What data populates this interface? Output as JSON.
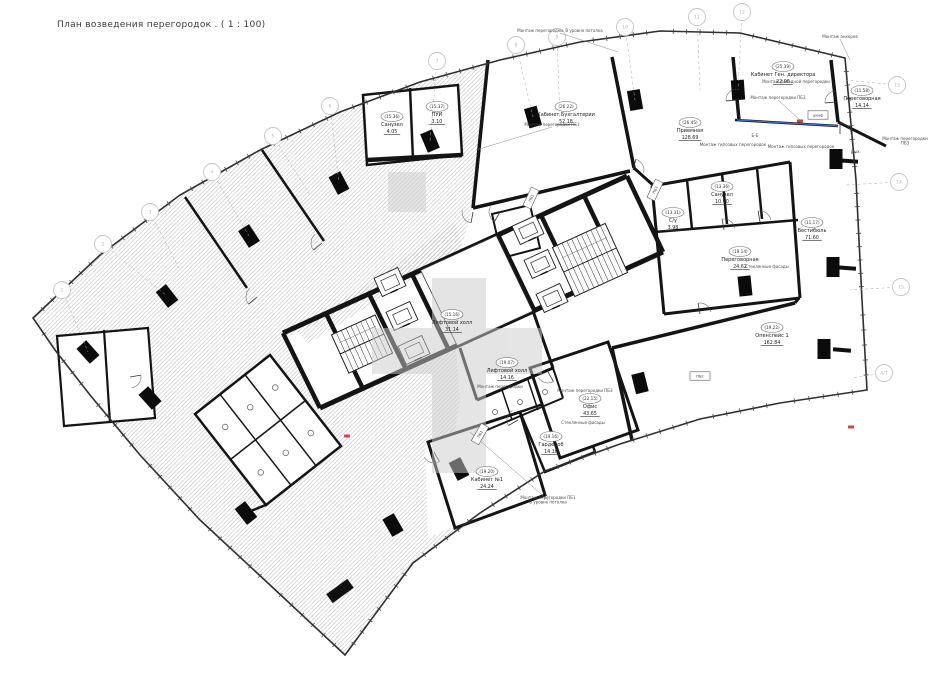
{
  "title": "План возведения перегородок . ( 1 : 100)",
  "colors": {
    "wall": "#141414",
    "thin_line": "#3a3a3a",
    "hatch": "#b3b3b3",
    "bubble": "#c4c4c4",
    "watermark": "#cbcbcb",
    "accent_blue": "#3a6fd8",
    "accent_red": "#d04545"
  },
  "plan": {
    "outline": [
      [
        33,
        318
      ],
      [
        100,
        255
      ],
      [
        180,
        195
      ],
      [
        260,
        150
      ],
      [
        340,
        112
      ],
      [
        420,
        82
      ],
      [
        500,
        60
      ],
      [
        580,
        42
      ],
      [
        660,
        31
      ],
      [
        740,
        33
      ],
      [
        845,
        58
      ],
      [
        856,
        180
      ],
      [
        862,
        300
      ],
      [
        867,
        390
      ],
      [
        780,
        403
      ],
      [
        700,
        419
      ],
      [
        620,
        444
      ],
      [
        545,
        471
      ],
      [
        480,
        513
      ],
      [
        413,
        563
      ],
      [
        345,
        655
      ],
      [
        270,
        585
      ],
      [
        200,
        520
      ],
      [
        140,
        455
      ],
      [
        90,
        395
      ],
      [
        55,
        350
      ]
    ],
    "white_zone": [
      [
        490,
        58
      ],
      [
        560,
        45
      ],
      [
        640,
        33
      ],
      [
        700,
        29
      ],
      [
        760,
        37
      ],
      [
        845,
        58
      ],
      [
        856,
        180
      ],
      [
        862,
        300
      ],
      [
        867,
        390
      ],
      [
        780,
        403
      ],
      [
        700,
        419
      ],
      [
        620,
        444
      ],
      [
        545,
        471
      ],
      [
        505,
        494
      ],
      [
        455,
        526
      ],
      [
        428,
        538
      ],
      [
        425,
        445
      ],
      [
        455,
        430
      ],
      [
        460,
        400
      ],
      [
        456,
        350
      ],
      [
        322,
        410
      ],
      [
        286,
        338
      ],
      [
        460,
        252
      ],
      [
        473,
        208
      ]
    ],
    "hatch_patches": [
      [
        [
          298,
          332
        ],
        [
          455,
          222
        ],
        [
          462,
          248
        ],
        [
          308,
          344
        ]
      ]
    ],
    "white_rooms": [
      {
        "p": [
          [
            363,
            95
          ],
          [
            458,
            85
          ],
          [
            462,
            155
          ],
          [
            367,
            165
          ]
        ],
        "w": 2.5
      },
      {
        "p": [
          [
            195,
            414
          ],
          [
            270,
            355
          ],
          [
            341,
            446
          ],
          [
            266,
            505
          ]
        ],
        "w": 2.5,
        "grid": "wc"
      },
      {
        "p": [
          [
            57,
            336
          ],
          [
            148,
            328
          ],
          [
            155,
            418
          ],
          [
            64,
            426
          ]
        ],
        "w": 2.2
      },
      {
        "p": [
          [
            428,
            442
          ],
          [
            520,
            412
          ],
          [
            545,
            495
          ],
          [
            455,
            528
          ]
        ],
        "w": 3
      },
      {
        "p": [
          [
            520,
            412
          ],
          [
            575,
            393
          ],
          [
            595,
            452
          ],
          [
            545,
            472
          ]
        ],
        "w": 2.5
      },
      {
        "p": [
          [
            530,
            368
          ],
          [
            608,
            342
          ],
          [
            638,
            430
          ],
          [
            560,
            458
          ]
        ],
        "w": 3
      },
      {
        "p": [
          [
            492,
            214
          ],
          [
            530,
            205
          ],
          [
            540,
            248
          ],
          [
            502,
            258
          ]
        ],
        "w": 2
      }
    ],
    "walls": [
      [
        488,
        60,
        473,
        208,
        3.5
      ],
      [
        473,
        208,
        630,
        171,
        3.5
      ],
      [
        612,
        57,
        634,
        168,
        3.5
      ],
      [
        634,
        168,
        654,
        186,
        3
      ],
      [
        733,
        57,
        739,
        120,
        3.5
      ],
      [
        831,
        60,
        838,
        122,
        3.5
      ],
      [
        838,
        122,
        886,
        146,
        3
      ],
      [
        652,
        186,
        790,
        162,
        3
      ],
      [
        790,
        162,
        800,
        298,
        3
      ],
      [
        652,
        186,
        664,
        314,
        3
      ],
      [
        655,
        232,
        798,
        220,
        2.5
      ],
      [
        687,
        180,
        692,
        229,
        2.5
      ],
      [
        722,
        174,
        727,
        224,
        2.5
      ],
      [
        757,
        168,
        762,
        219,
        2.5
      ],
      [
        664,
        314,
        800,
        298,
        3
      ],
      [
        612,
        348,
        795,
        303,
        3.5
      ],
      [
        795,
        303,
        799,
        298,
        3
      ],
      [
        612,
        348,
        632,
        440,
        3.5
      ],
      [
        533,
        311,
        553,
        368,
        3
      ],
      [
        553,
        368,
        477,
        400,
        3
      ],
      [
        477,
        400,
        460,
        348,
        3
      ],
      [
        553,
        368,
        563,
        398,
        2
      ],
      [
        563,
        398,
        487,
        430,
        2
      ],
      [
        502,
        390,
        512,
        420,
        1.5
      ],
      [
        528,
        380,
        538,
        410,
        1.5
      ],
      [
        185,
        197,
        247,
        288,
        2.5
      ],
      [
        262,
        150,
        324,
        241,
        2.5
      ],
      [
        246,
        513,
        268,
        504,
        2.5
      ],
      [
        410,
        88,
        413,
        160,
        2.5
      ],
      [
        367,
        160,
        462,
        155,
        4.5
      ],
      [
        104,
        330,
        110,
        423,
        2.2
      ],
      [
        735,
        120,
        838,
        126,
        2.5
      ]
    ],
    "wall_stubs": [
      [
        340,
        591,
        26,
        11,
        -36
      ],
      [
        848,
        161,
        20,
        4,
        4
      ],
      [
        846,
        268,
        20,
        4,
        4
      ],
      [
        842,
        350,
        18,
        4,
        5
      ]
    ],
    "columns": [
      [
        88,
        352,
        -42
      ],
      [
        167,
        296,
        -38
      ],
      [
        249,
        236,
        -33
      ],
      [
        339,
        183,
        -28
      ],
      [
        430,
        141,
        -23
      ],
      [
        533,
        117,
        -16
      ],
      [
        635,
        100,
        -10
      ],
      [
        738,
        90,
        -4
      ],
      [
        836,
        159,
        0
      ],
      [
        833,
        267,
        0
      ],
      [
        824,
        349,
        0
      ],
      [
        150,
        398,
        -42
      ],
      [
        246,
        513,
        -38
      ],
      [
        393,
        525,
        -30
      ],
      [
        459,
        469,
        -27
      ],
      [
        640,
        383,
        -14
      ],
      [
        745,
        286,
        -6
      ]
    ],
    "core": {
      "top": [
        [
          283,
          333
        ],
        [
          627,
          176
        ]
      ],
      "bottom": [
        [
          320,
          408
        ],
        [
          663,
          252
        ]
      ],
      "webs": 8,
      "hall": [
        0.4,
        0.62
      ]
    },
    "elevators": [
      [
        390,
        282
      ],
      [
        402,
        316
      ],
      [
        414,
        350
      ],
      [
        528,
        230
      ],
      [
        540,
        264
      ],
      [
        552,
        298
      ]
    ],
    "stairs": [
      {
        "cx": 590,
        "cy": 260,
        "w": 58,
        "h": 54,
        "rot": -24.5,
        "steps": 11
      },
      {
        "cx": 362,
        "cy": 344,
        "w": 48,
        "h": 42,
        "rot": -24.5,
        "steps": 9
      }
    ],
    "doors": [
      [
        473,
        212,
        100
      ],
      [
        633,
        170,
        -75
      ],
      [
        737,
        100,
        175
      ],
      [
        836,
        102,
        175
      ],
      [
        724,
        230,
        -100
      ],
      [
        760,
        222,
        -100
      ],
      [
        548,
        372,
        60
      ],
      [
        518,
        420,
        150
      ],
      [
        434,
        452,
        60
      ],
      [
        257,
        297,
        140
      ],
      [
        322,
        243,
        140
      ],
      [
        130,
        377,
        -10
      ],
      [
        700,
        314,
        -100
      ],
      [
        840,
        134,
        -90
      ],
      [
        500,
        212,
        120
      ]
    ],
    "toilets_wc_center": [
      [
        495,
        412
      ],
      [
        520,
        402
      ],
      [
        545,
        392
      ]
    ],
    "room_labels": [
      {
        "id": "26.22",
        "name": "Кабинет Бухгалтерии",
        "area": "52.18",
        "x": 566,
        "y": 108
      },
      {
        "id": "25.39",
        "name": "Кабинет Ген. директора",
        "area": "22.06",
        "x": 783,
        "y": 68
      },
      {
        "id": "11.58",
        "name": "Переговорная",
        "area": "14.14",
        "x": 862,
        "y": 92
      },
      {
        "id": "26.45",
        "name": "Приемная",
        "area": "128.69",
        "x": 690,
        "y": 124
      },
      {
        "id": "15.16",
        "name": "Лифтовой холл",
        "area": "31.14",
        "x": 452,
        "y": 316
      },
      {
        "id": "19.07",
        "name": "Лифтовой холл",
        "area": "14.16",
        "x": 507,
        "y": 364
      },
      {
        "id": "19.14",
        "name": "Переговорная",
        "area": "24.62",
        "x": 740,
        "y": 253
      },
      {
        "id": "11.17",
        "name": "Вестибюль",
        "area": "71.60",
        "x": 812,
        "y": 224
      },
      {
        "id": "19.22",
        "name": "Опенспейс 1",
        "area": "162.84",
        "x": 772,
        "y": 329
      },
      {
        "id": "22.15",
        "name": "Офис",
        "area": "43.65",
        "x": 590,
        "y": 400
      },
      {
        "id": "19.20",
        "name": "Кабинет №1",
        "area": "24.24",
        "x": 487,
        "y": 473
      },
      {
        "id": "19.16",
        "name": "Гардероб",
        "area": "14.18",
        "x": 551,
        "y": 438
      },
      {
        "id": "13.36",
        "name": "Санузел",
        "area": "10.90",
        "x": 722,
        "y": 188
      },
      {
        "id": "13.31",
        "name": "С/у",
        "area": "3.98",
        "x": 673,
        "y": 214
      },
      {
        "id": "15.36",
        "name": "Санузел",
        "area": "4.05",
        "x": 392,
        "y": 118
      },
      {
        "id": "15.37",
        "name": "ПУИ",
        "area": "3.10",
        "x": 437,
        "y": 108
      }
    ],
    "annotations": [
      {
        "t": "Монтаж перегородки. В уровне потолка",
        "x": 560,
        "y": 32,
        "l": [
          618,
          52
        ]
      },
      {
        "t": "Монтаж анкеров",
        "x": 840,
        "y": 38,
        "l": [
          850,
          60
        ]
      },
      {
        "t": "Монтаж перегородки ПБ1",
        "x": 552,
        "y": 126,
        "l": [
          476,
          150
        ]
      },
      {
        "t": "Монтаж фасадной перегородки",
        "x": 796,
        "y": 83
      },
      {
        "t": "Монтаж перегородки ПБ3",
        "x": 778,
        "y": 99,
        "l": [
          800,
          120
        ]
      },
      {
        "t": "Монтаж гипсовых перегородок",
        "x": 733,
        "y": 146
      },
      {
        "t": "Монтаж гипсовых перегородок",
        "x": 801,
        "y": 148
      },
      {
        "t": "Монтаж перегородки\nПБ3",
        "x": 905,
        "y": 140
      },
      {
        "t": "Вых.",
        "x": 856,
        "y": 153
      },
      {
        "t": "Монтаж перегородки ПБ1\nВ уровне потолка",
        "x": 548,
        "y": 499,
        "l": [
          470,
          432
        ]
      },
      {
        "t": "Монтаж перегородки",
        "x": 500,
        "y": 388
      },
      {
        "t": "Монтаж перегородки ПБ3",
        "x": 585,
        "y": 392
      },
      {
        "t": "Стеклянные фасады",
        "x": 767,
        "y": 268
      },
      {
        "t": "Стеклянные фасады",
        "x": 583,
        "y": 424
      },
      {
        "t": "Б-Б",
        "x": 755,
        "y": 137
      }
    ],
    "tags": [
      {
        "t": "ПБ1",
        "x": 531,
        "y": 198,
        "r": -65
      },
      {
        "t": "ПБ3",
        "x": 655,
        "y": 190,
        "r": -65
      },
      {
        "t": "шкаф",
        "x": 818,
        "y": 115,
        "r": 0
      },
      {
        "t": "ПБ1",
        "x": 480,
        "y": 434,
        "r": -60
      },
      {
        "t": "ПБ2",
        "x": 700,
        "y": 376,
        "r": 0
      }
    ],
    "grid_bubbles": [
      {
        "label": "1",
        "x": 62,
        "y": 290,
        "t": [
          88,
          352
        ]
      },
      {
        "label": "2",
        "x": 103,
        "y": 244,
        "t": [
          167,
          296
        ]
      },
      {
        "label": "3",
        "x": 150,
        "y": 212,
        "t": [
          180,
          270
        ]
      },
      {
        "label": "4",
        "x": 212,
        "y": 172,
        "t": [
          249,
          236
        ]
      },
      {
        "label": "5",
        "x": 273,
        "y": 136,
        "t": [
          310,
          195
        ]
      },
      {
        "label": "6",
        "x": 330,
        "y": 106,
        "t": [
          339,
          183
        ]
      },
      {
        "label": "7",
        "x": 437,
        "y": 61,
        "t": [
          430,
          141
        ]
      },
      {
        "label": "8",
        "x": 516,
        "y": 45,
        "t": [
          533,
          117
        ]
      },
      {
        "label": "9",
        "x": 557,
        "y": 37,
        "t": [
          560,
          120
        ]
      },
      {
        "label": "10",
        "x": 625,
        "y": 27,
        "t": [
          635,
          100
        ]
      },
      {
        "label": "11",
        "x": 697,
        "y": 17,
        "t": [
          700,
          90
        ]
      },
      {
        "label": "12",
        "x": 742,
        "y": 12,
        "t": [
          738,
          90
        ]
      },
      {
        "label": "13",
        "x": 897,
        "y": 85,
        "t": [
          845,
          80
        ]
      },
      {
        "label": "14",
        "x": 899,
        "y": 182,
        "t": [
          846,
          185
        ]
      },
      {
        "label": "15",
        "x": 901,
        "y": 287,
        "t": [
          850,
          290
        ]
      },
      {
        "label": "А/Т",
        "x": 884,
        "y": 373,
        "t": [
          852,
          378
        ]
      }
    ],
    "accents": {
      "blue_line": [
        737,
        120,
        838,
        126
      ],
      "red_marks": [
        [
          800,
          121
        ],
        [
          347,
          436
        ],
        [
          851,
          427
        ]
      ]
    },
    "watermark": [
      [
        432,
        278,
        54,
        195
      ],
      [
        372,
        328,
        170,
        46
      ],
      [
        388,
        172,
        38,
        40
      ]
    ]
  }
}
